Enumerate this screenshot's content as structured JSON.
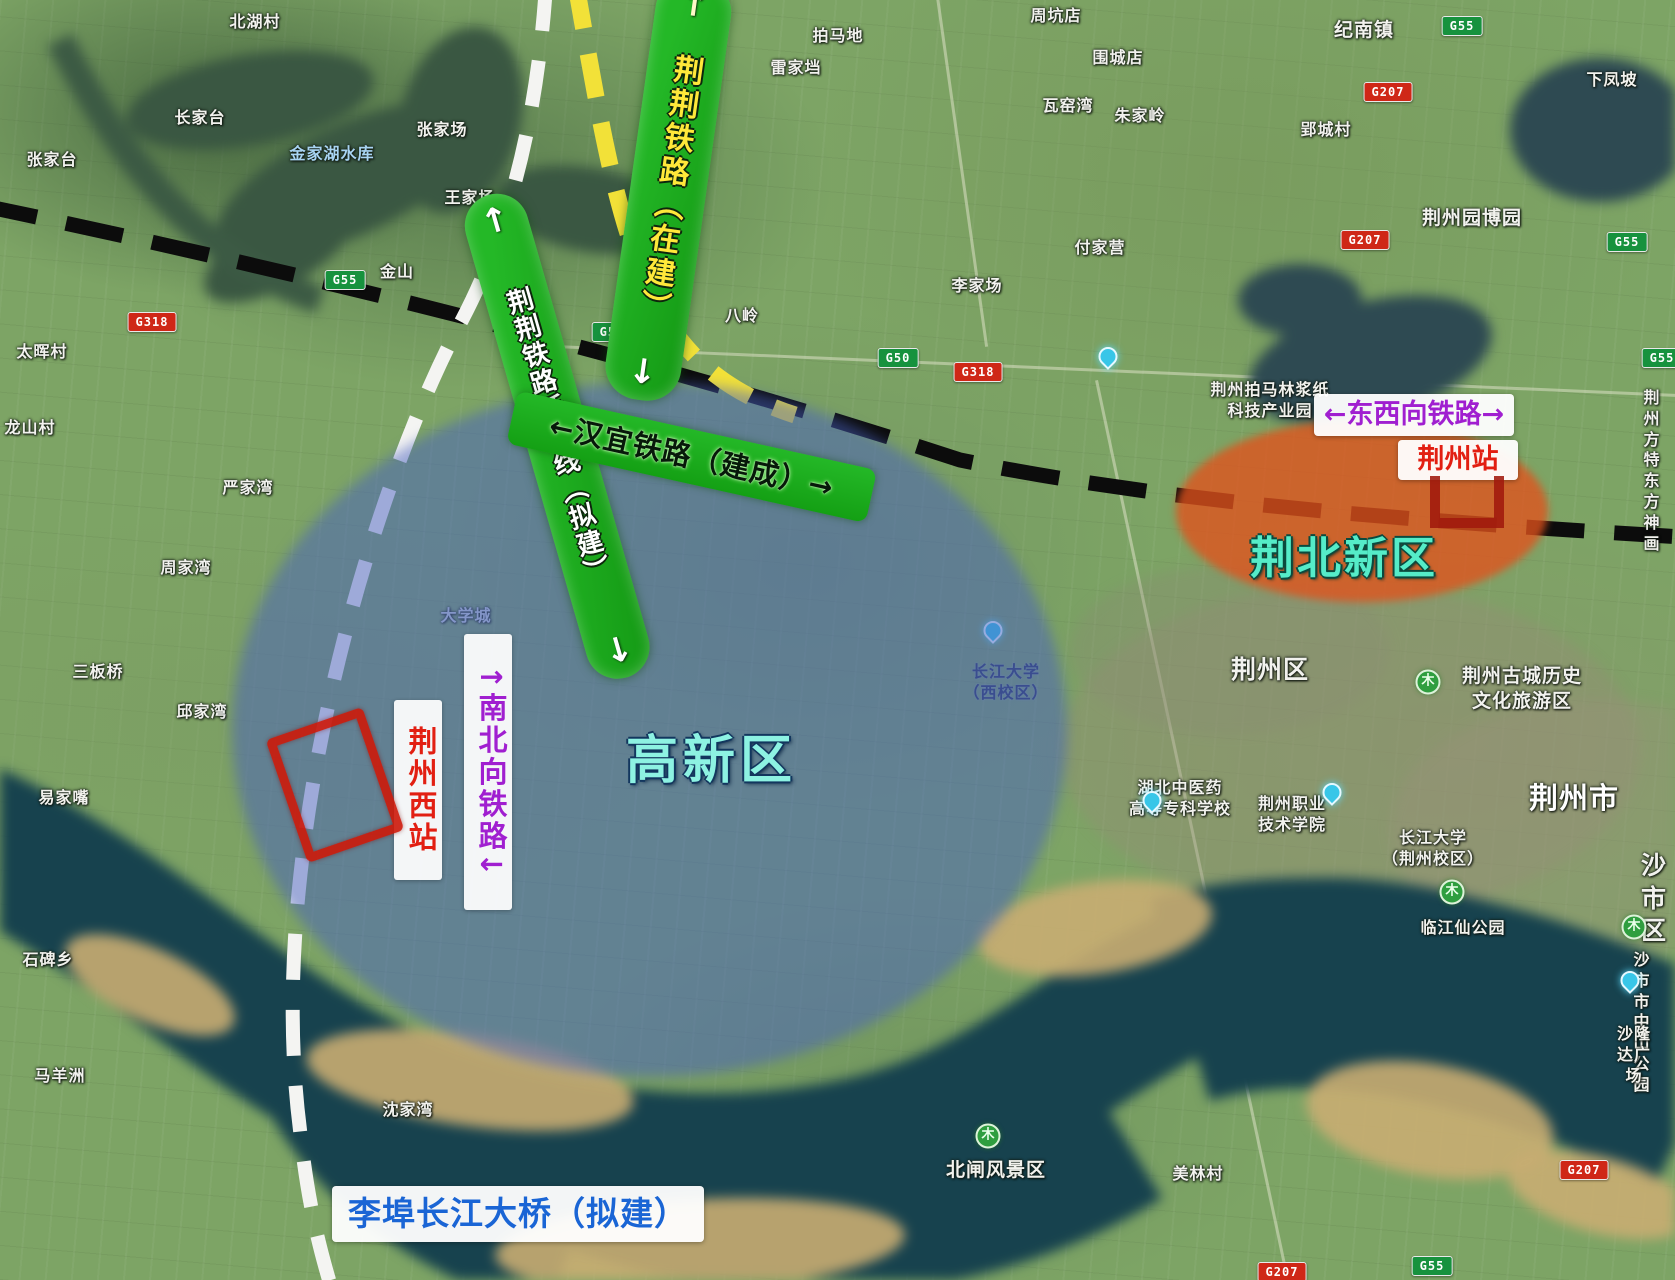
{
  "colors": {
    "band-green": "#24b827",
    "rail-yellow": "#ffe83a",
    "zone-blue": "#4860c0",
    "zone-orange": "#e2521c",
    "purple": "#a01fd0",
    "red": "#e21f12",
    "cyan": "#55ecc8",
    "blue-text": "#1a65d5"
  },
  "annotations": {
    "jingjing_railway": {
      "arrow_top": "↑",
      "text": "荆荆铁路（在建）",
      "arrow_bottom": "↓"
    },
    "jingjing_extension": {
      "arrow_top": "↑",
      "text": "荆荆铁路延长线（拟建）",
      "arrow_bottom": "↓"
    },
    "hanyi_railway": "←汉宜铁路（建成）→",
    "east_west_railway": "←东西向铁路→",
    "north_south_railway": "↑南北向铁路↓",
    "jingzhou_station": "荆州站",
    "jingzhou_west_station": "荆州西站",
    "jingbei_new_district": "荆北新区",
    "gaoxin_district": "高新区",
    "bridge": "李埠长江大桥（拟建）"
  },
  "map_labels": [
    {
      "text": "北湖村",
      "x": 255,
      "y": 12
    },
    {
      "text": "张家台",
      "x": 52,
      "y": 150
    },
    {
      "text": "长家台",
      "x": 200,
      "y": 108
    },
    {
      "text": "金家湖水库",
      "x": 332,
      "y": 144,
      "cls": "water-name"
    },
    {
      "text": "张家场",
      "x": 442,
      "y": 120
    },
    {
      "text": "王家场",
      "x": 470,
      "y": 188
    },
    {
      "text": "金山",
      "x": 397,
      "y": 262
    },
    {
      "text": "拍马地",
      "x": 838,
      "y": 26
    },
    {
      "text": "雷家垱",
      "x": 796,
      "y": 58
    },
    {
      "text": "李家场",
      "x": 977,
      "y": 276
    },
    {
      "text": "八岭",
      "x": 742,
      "y": 306
    },
    {
      "text": "周坑店",
      "x": 1056,
      "y": 6
    },
    {
      "text": "围城店",
      "x": 1118,
      "y": 48
    },
    {
      "text": "瓦窑湾",
      "x": 1068,
      "y": 96
    },
    {
      "text": "朱家岭",
      "x": 1140,
      "y": 106
    },
    {
      "text": "纪南镇",
      "x": 1364,
      "y": 18,
      "cls": "md"
    },
    {
      "text": "下凤坡",
      "x": 1612,
      "y": 70
    },
    {
      "text": "郢城村",
      "x": 1326,
      "y": 120
    },
    {
      "text": "付家营",
      "x": 1100,
      "y": 238
    },
    {
      "text": "荆州园博园",
      "x": 1472,
      "y": 206,
      "cls": "md"
    },
    {
      "text": "荆州拍马林浆纸\n科技产业园",
      "x": 1270,
      "y": 380
    },
    {
      "text": "荆州方特\n东方神画",
      "x": 1652,
      "y": 388
    },
    {
      "text": "荆州区",
      "x": 1270,
      "y": 654,
      "cls": "big"
    },
    {
      "text": "荆州古城历史\n文化旅游区",
      "x": 1522,
      "y": 664,
      "cls": "md"
    },
    {
      "text": "大学城",
      "x": 466,
      "y": 606,
      "cls": "dim"
    },
    {
      "text": "长江大学\n（西校区）",
      "x": 1006,
      "y": 662,
      "cls": "dark"
    },
    {
      "text": "湖北中医药\n高等专科学校",
      "x": 1180,
      "y": 778
    },
    {
      "text": "荆州职业\n技术学院",
      "x": 1292,
      "y": 794
    },
    {
      "text": "长江大学\n（荆州校区）",
      "x": 1433,
      "y": 828
    },
    {
      "text": "荆州市",
      "x": 1574,
      "y": 780,
      "cls": "huge"
    },
    {
      "text": "沙市区",
      "x": 1654,
      "y": 850,
      "cls": "big"
    },
    {
      "text": "临江仙公园",
      "x": 1463,
      "y": 918
    },
    {
      "text": "沙市市中山公园",
      "x": 1642,
      "y": 950
    },
    {
      "text": "沙隆达广场",
      "x": 1634,
      "y": 1024
    },
    {
      "text": "北闸风景区",
      "x": 996,
      "y": 1158,
      "cls": "md"
    },
    {
      "text": "美林村",
      "x": 1198,
      "y": 1164
    },
    {
      "text": "太晖村",
      "x": 42,
      "y": 342
    },
    {
      "text": "龙山村",
      "x": 30,
      "y": 418
    },
    {
      "text": "严家湾",
      "x": 248,
      "y": 478
    },
    {
      "text": "周家湾",
      "x": 186,
      "y": 558
    },
    {
      "text": "三板桥",
      "x": 98,
      "y": 662
    },
    {
      "text": "邱家湾",
      "x": 202,
      "y": 702
    },
    {
      "text": "易家嘴",
      "x": 64,
      "y": 788
    },
    {
      "text": "石碑乡",
      "x": 48,
      "y": 950
    },
    {
      "text": "马羊洲",
      "x": 60,
      "y": 1066
    },
    {
      "text": "沈家湾",
      "x": 408,
      "y": 1100
    }
  ],
  "road_shields": [
    {
      "code": "G55",
      "type": "g",
      "x": 1462,
      "y": 26
    },
    {
      "code": "G55",
      "type": "g",
      "x": 1627,
      "y": 242
    },
    {
      "code": "G55",
      "type": "g",
      "x": 1662,
      "y": 358
    },
    {
      "code": "G55",
      "type": "g",
      "x": 1432,
      "y": 1266
    },
    {
      "code": "G55",
      "type": "g",
      "x": 345,
      "y": 280
    },
    {
      "code": "G50",
      "type": "g",
      "x": 612,
      "y": 332
    },
    {
      "code": "G50",
      "type": "g",
      "x": 898,
      "y": 358
    },
    {
      "code": "G318",
      "type": "r",
      "x": 152,
      "y": 322
    },
    {
      "code": "G318",
      "type": "r",
      "x": 978,
      "y": 372
    },
    {
      "code": "G207",
      "type": "r",
      "x": 1388,
      "y": 92
    },
    {
      "code": "G207",
      "type": "r",
      "x": 1365,
      "y": 240
    },
    {
      "code": "G207",
      "type": "r",
      "x": 1584,
      "y": 1170
    },
    {
      "code": "G207",
      "type": "r",
      "x": 1282,
      "y": 1272
    }
  ],
  "markers": [
    {
      "kind": "pin",
      "x": 1108,
      "y": 366
    },
    {
      "kind": "pin",
      "x": 1152,
      "y": 810
    },
    {
      "kind": "pin",
      "x": 1332,
      "y": 802
    },
    {
      "kind": "pin",
      "x": 1630,
      "y": 990
    },
    {
      "kind": "pin",
      "x": 993,
      "y": 640
    },
    {
      "kind": "tree",
      "x": 1428,
      "y": 682,
      "glyph": "木"
    },
    {
      "kind": "tree",
      "x": 1452,
      "y": 892,
      "glyph": "木"
    },
    {
      "kind": "tree",
      "x": 1634,
      "y": 927,
      "glyph": "木"
    },
    {
      "kind": "tree",
      "x": 988,
      "y": 1136,
      "glyph": "木"
    }
  ]
}
